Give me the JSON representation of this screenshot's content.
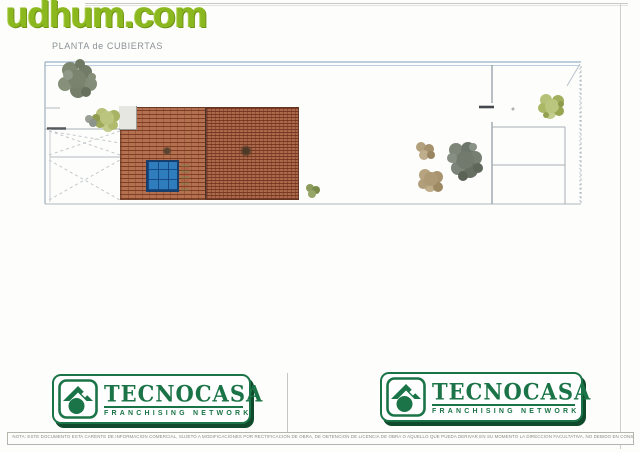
{
  "watermark": {
    "text": "udhum.com"
  },
  "plan": {
    "title": "PLANTA de CUBIERTAS"
  },
  "logo": {
    "brand": "TECNOCASA",
    "subtitle": "FRANCHISING NETWORK"
  },
  "footer": {
    "disclaimer": "NOTA: ESTE DOCUMENTO ESTA CARENTE DE INFORMACION COMERCIAL, SUJETO A MODIFICACIONES POR RECTIFICACION DE OBRA, DE OBTENCION DE LICENCIA DE OBRA O AQUELLO QUE PUEDA DERIVAR EN SU MOMENTO LA DIRECCION FACULTATIVA, NO DEBIDO EN CONSECUENCIA FACILITAR DESDE EL TITULO DE VISTA COMERCIAL, MOBILIARIO NO INCLUIDO"
  },
  "colors": {
    "brand_green": "#1b7447",
    "shadow_green": "#0e4a2b",
    "watermark_green": "#8bb81e",
    "brick": "#b3714f",
    "panel_blue": "#2f7dbd"
  }
}
